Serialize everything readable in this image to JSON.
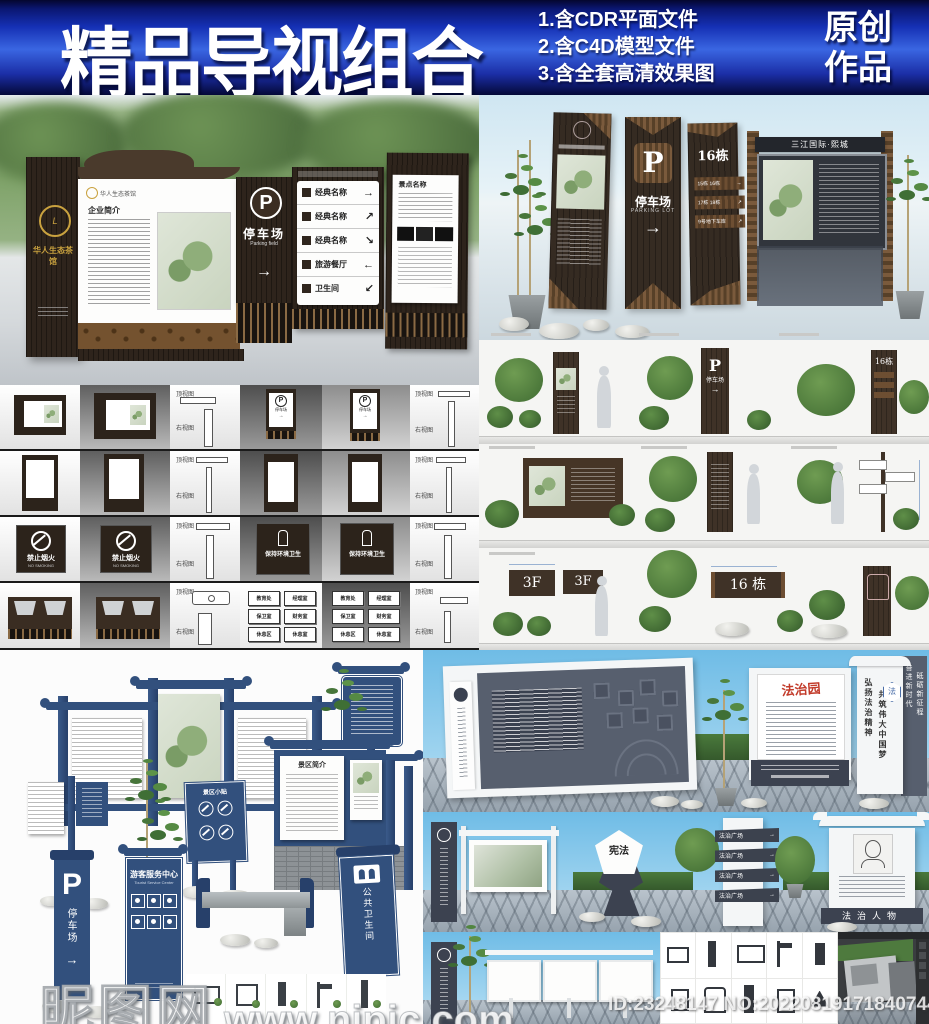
{
  "banner": {
    "title": "精品导视组合",
    "features": [
      "1.含CDR平面文件",
      "2.含C4D模型文件",
      "3.含全套高清效果图"
    ],
    "badge": [
      "原创",
      "作品"
    ],
    "accent_color": "#2a52d8"
  },
  "wood_showcase": {
    "brand": "华人生态茶馆",
    "profile_title": "企业简介",
    "parking": {
      "letter": "P",
      "cn": "停车场",
      "en": "Parking field",
      "arrow": "→"
    },
    "directory": [
      {
        "label": "经典名称",
        "arrow": "→"
      },
      {
        "label": "经典名称",
        "arrow": "↗"
      },
      {
        "label": "经典名称",
        "arrow": "↘"
      },
      {
        "label": "旅游餐厅",
        "arrow": "←"
      },
      {
        "label": "卫生间",
        "arrow": "↙"
      }
    ],
    "spots_title": "景点名称"
  },
  "pylon_showcase": {
    "board_header": "三江国际·熙城",
    "parking": {
      "letter": "P",
      "cn": "停车场",
      "en": "PARKING LOT",
      "arrow": "→"
    },
    "building": {
      "title": "16栋",
      "plaques": [
        {
          "label": "15栋 16栋",
          "arrow": "→"
        },
        {
          "label": "17栋 18栋",
          "arrow": "↗"
        },
        {
          "label": "9号地下车库",
          "arrow": "↗"
        }
      ]
    }
  },
  "elevation_grid": {
    "top_view_label": "顶视图",
    "side_view_label": "右视图",
    "no_smoking": {
      "cn": "禁止烟火",
      "en": "NO SMOKING"
    },
    "hygiene": "保持环境卫生",
    "parking": {
      "letter": "P",
      "cn": "停车场",
      "arrow": "→"
    },
    "plaques": [
      "教育处",
      "经理室",
      "保卫室",
      "财务室",
      "休息区",
      "休息室"
    ]
  },
  "scene_grid": {
    "parking": {
      "letter": "P",
      "cn": "停车场",
      "arrow": "→"
    },
    "building_title": "16栋",
    "floor_plate": "3F",
    "floor_plate2": "3F",
    "number_plate": "16 栋"
  },
  "blue_showcase": {
    "intro_title": "景区简介",
    "tips_title": "景区小贴",
    "parking": {
      "letter": "P",
      "cn": "停车场",
      "arrow": "→"
    },
    "service": {
      "cn": "游客服务中心",
      "en": "Tourist Service Center"
    },
    "toilet": "公共卫生间"
  },
  "law_showcase": {
    "garden_title": "法治园",
    "pylon_cols": [
      "弘扬法治精神",
      "共筑伟大中国梦"
    ],
    "back_cols": [
      "奋进新时代",
      "砥砺新征程"
    ],
    "badge": "法",
    "constitution": "宪法",
    "plaza_rows": [
      {
        "label": "法治广场",
        "arrow": "→"
      },
      {
        "label": "法治广场",
        "arrow": "→"
      },
      {
        "label": "法治广场",
        "arrow": "→"
      },
      {
        "label": "法治广场",
        "arrow": "→"
      }
    ],
    "figures_base": "法治人物"
  },
  "watermark": {
    "site": "昵图网",
    "url": "www.nipic.com"
  },
  "id_line": "ID:23248147 NO:20220819171840744105"
}
